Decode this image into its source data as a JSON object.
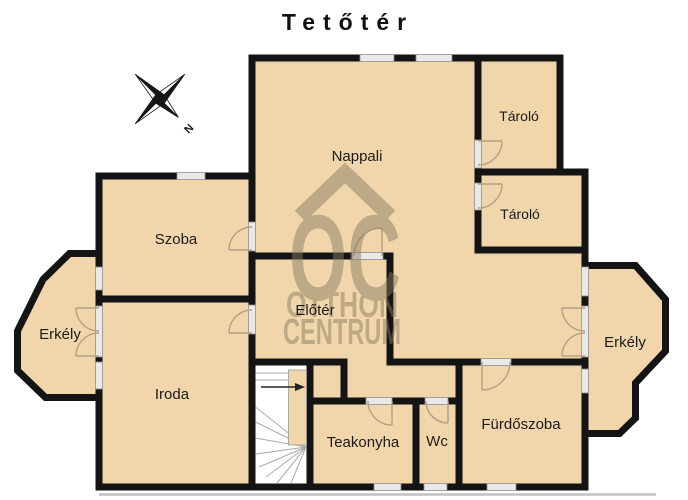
{
  "title": "Tetőtér",
  "compass": {
    "north_label": "N"
  },
  "watermark": {
    "monogram": "OC",
    "line1": "OTTHON",
    "line2": "CENTRUM"
  },
  "rooms": [
    {
      "id": "nappali",
      "label": "Nappali"
    },
    {
      "id": "tarolo-upper",
      "label": "Tároló"
    },
    {
      "id": "tarolo-lower",
      "label": "Tároló"
    },
    {
      "id": "szoba",
      "label": "Szoba"
    },
    {
      "id": "erkely-left",
      "label": "Erkély"
    },
    {
      "id": "erkely-right",
      "label": "Erkély"
    },
    {
      "id": "eloter",
      "label": "Előtér"
    },
    {
      "id": "iroda",
      "label": "Iroda"
    },
    {
      "id": "teakonyha",
      "label": "Teakonyha"
    },
    {
      "id": "wc",
      "label": "Wc"
    },
    {
      "id": "furdoszoba",
      "label": "Fürdőszoba"
    }
  ],
  "colors": {
    "room_fill": "#f0d6aa",
    "wall": "#141414",
    "window_sill": "#e9e9e9",
    "door_arc": "#b3a183",
    "watermark": "#8a7a62",
    "background": "#ffffff",
    "label_text": "#1b1b1b"
  }
}
